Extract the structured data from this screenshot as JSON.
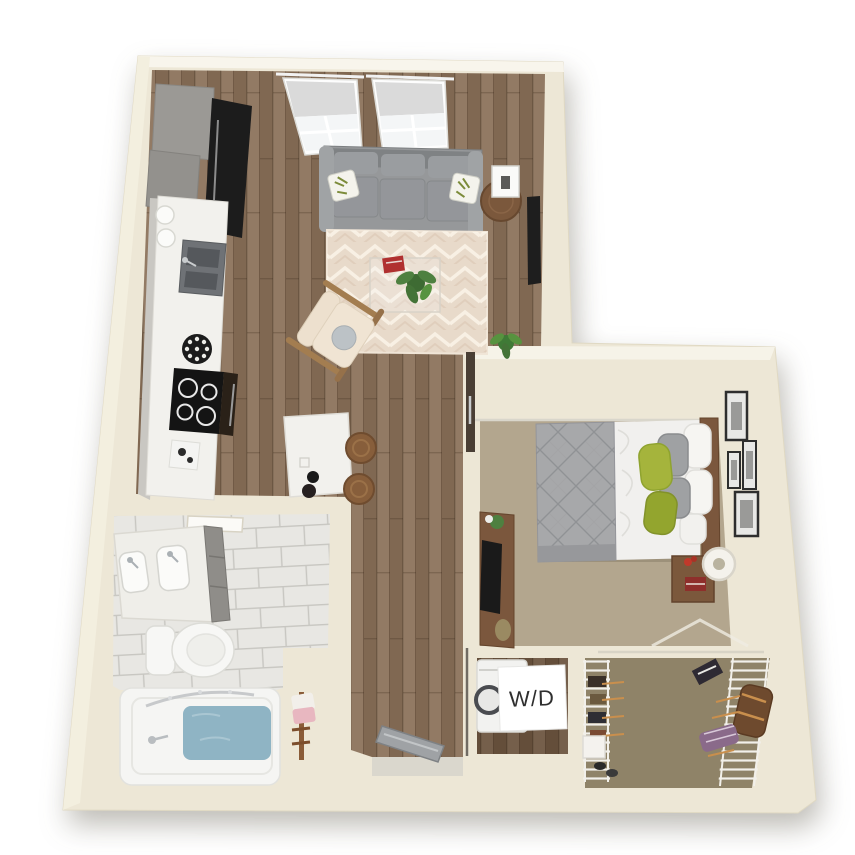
{
  "title": "3D apartment floor plan — studio/one-bedroom unit, top-down render",
  "labels": {
    "washer_dryer": "W/D"
  },
  "palette": {
    "background": "#FFFFFF",
    "wall": "#EDE7D6",
    "wall_highlight": "#F7F4EA",
    "floor_wood": "#8A715A",
    "floor_wood_dark": "#6B5440",
    "rug": "#E8DACA",
    "carpet_bedroom": "#B3A68E",
    "carpet_closet": "#8F8368",
    "tile": "#E8E7E3",
    "water": "#8FB4C4",
    "sofa": "#96989A",
    "duvet": "#A7A8AA",
    "sheets": "#F1F0EE",
    "pillow_green": "#A5B43C",
    "wood_furniture": "#7B583C",
    "counter": "#F2F1ED",
    "cabinet_gray": "#9B9995",
    "appliance_dark": "#1C1C1C",
    "washer": "#F2F2F0",
    "label_bg": "#FFFFFF",
    "label_text": "#2F2F2F"
  },
  "rooms": [
    {
      "name": "Kitchen",
      "items": [
        "gray upper cabinets",
        "dark refrigerator",
        "white countertop run",
        "double stainless sink",
        "black cooktop with oven",
        "cookie plate",
        "white canisters",
        "marble island with bowls",
        "two wooden stools"
      ]
    },
    {
      "name": "Living room",
      "items": [
        "two windows with roller shades",
        "gray three-seat sofa",
        "leaf-print accent pillows",
        "round side table with lamp",
        "wall-mounted TV",
        "chevron area rug",
        "glass coffee table with red book",
        "potted plants",
        "wood-frame lounge chair"
      ]
    },
    {
      "name": "Bedroom",
      "items": [
        "bed with gray quilted duvet",
        "white sheets",
        "gray and green pillows",
        "wood headboard",
        "nightstand with lamp and books",
        "media console with TV and plant",
        "four picture frames on wall"
      ]
    },
    {
      "name": "Bathroom",
      "items": [
        "double-sink vanity",
        "toilet",
        "bathtub filled with water",
        "curved shower rod",
        "towel ladder",
        "marble tile floor"
      ]
    },
    {
      "name": "Laundry closet",
      "items": [
        "washer/dryer unit",
        "W/D placard"
      ]
    },
    {
      "name": "Walk-in closet",
      "items": [
        "white wire shelving",
        "hanging clothes",
        "duffel bag",
        "storage box"
      ]
    },
    {
      "name": "Hallway and entry",
      "items": [
        "wood plank flooring",
        "open entry door"
      ]
    }
  ]
}
